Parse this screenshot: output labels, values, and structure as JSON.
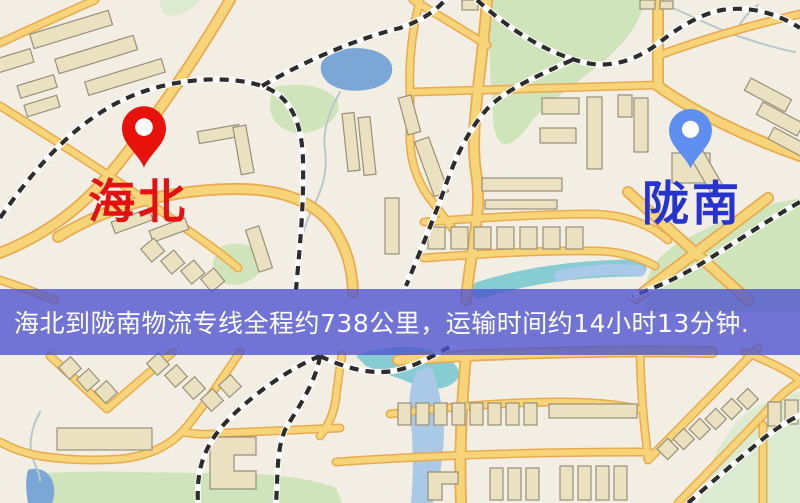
{
  "map": {
    "origin_marker": {
      "label": "海北",
      "pin_icon": "red-map-pin"
    },
    "destination_marker": {
      "label": "陇南",
      "pin_icon": "blue-map-pin"
    }
  },
  "banner": {
    "text": "海北到陇南物流专线全程约738公里，运输时间约14小时13分钟."
  },
  "theme": {
    "map-bg": "#f3eee3",
    "road-fill": "#f6d477",
    "road-casing": "#e9aa50",
    "building-fill": "#eae1c0",
    "building-stroke": "#98907a",
    "green": "#cfe4ba",
    "green-light": "#dcead0",
    "water-blue": "#7ba7d7",
    "water-teal": "#86ccd2",
    "water-pale": "#a9c9e6",
    "rail-dark": "#2d2d2d",
    "rail-light": "#ffffff",
    "stream": "#b7c9c9",
    "banner-bg": "rgba(76,82,208,0.78)",
    "banner-text": "#ffffff",
    "origin-color": "#e8120b",
    "origin-label-color": "#e31111",
    "dest-color": "#5e8ef0",
    "dest-label-color": "#2633cf"
  }
}
